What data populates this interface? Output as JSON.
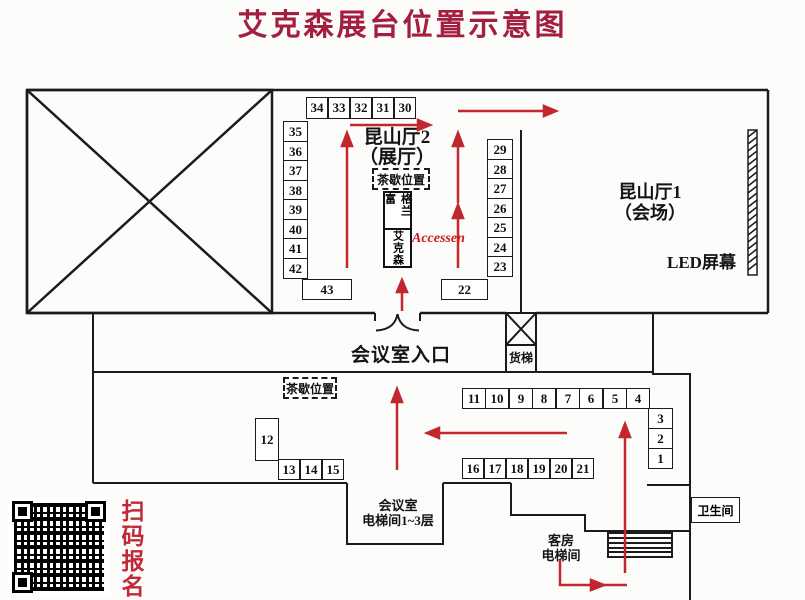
{
  "page": {
    "title": "艾克森展台位置示意图"
  },
  "colors": {
    "title": "#a31f3f",
    "arrow": "#c1272d",
    "accessen_text": "#cc1b24",
    "qr_caption": "#c0293a",
    "line": "#1b1b1b"
  },
  "halls": {
    "hall2_name": "昆山厅2",
    "hall2_sub": "（展厅）",
    "hall1_name": "昆山厅1",
    "hall1_sub": "（会场）",
    "led_screen": "LED屏幕"
  },
  "labels": {
    "tea_break_top": "茶歇位置",
    "tea_break_bottom": "茶歇位置",
    "entrance": "会议室入口",
    "freight_elevator": "货梯",
    "meeting_elevator_line1": "会议室",
    "meeting_elevator_line2": "电梯间1~3层",
    "guest_elevator_line1": "客房",
    "guest_elevator_line2": "电梯间",
    "toilet": "卫生间",
    "qr_caption": "扫码报名"
  },
  "featured": {
    "grundfos": "格兰富",
    "accessen_cn": "艾克森",
    "accessen_en": "Accessen"
  },
  "booths": {
    "top_row": [
      "34",
      "33",
      "32",
      "31",
      "30"
    ],
    "left_col": [
      "35",
      "36",
      "37",
      "38",
      "39",
      "40",
      "41",
      "42"
    ],
    "right_col": [
      "29",
      "28",
      "27",
      "26",
      "25",
      "24",
      "23"
    ],
    "wide_left": "43",
    "wide_right": "22",
    "mid_row": [
      "11",
      "10",
      "9",
      "8",
      "7",
      "6",
      "5",
      "4"
    ],
    "right_small_col": [
      "3",
      "2",
      "1"
    ],
    "lower_row": [
      "16",
      "17",
      "18",
      "19",
      "20",
      "21"
    ],
    "tall_booth": "12",
    "lower_left_row": [
      "13",
      "14",
      "15"
    ]
  }
}
